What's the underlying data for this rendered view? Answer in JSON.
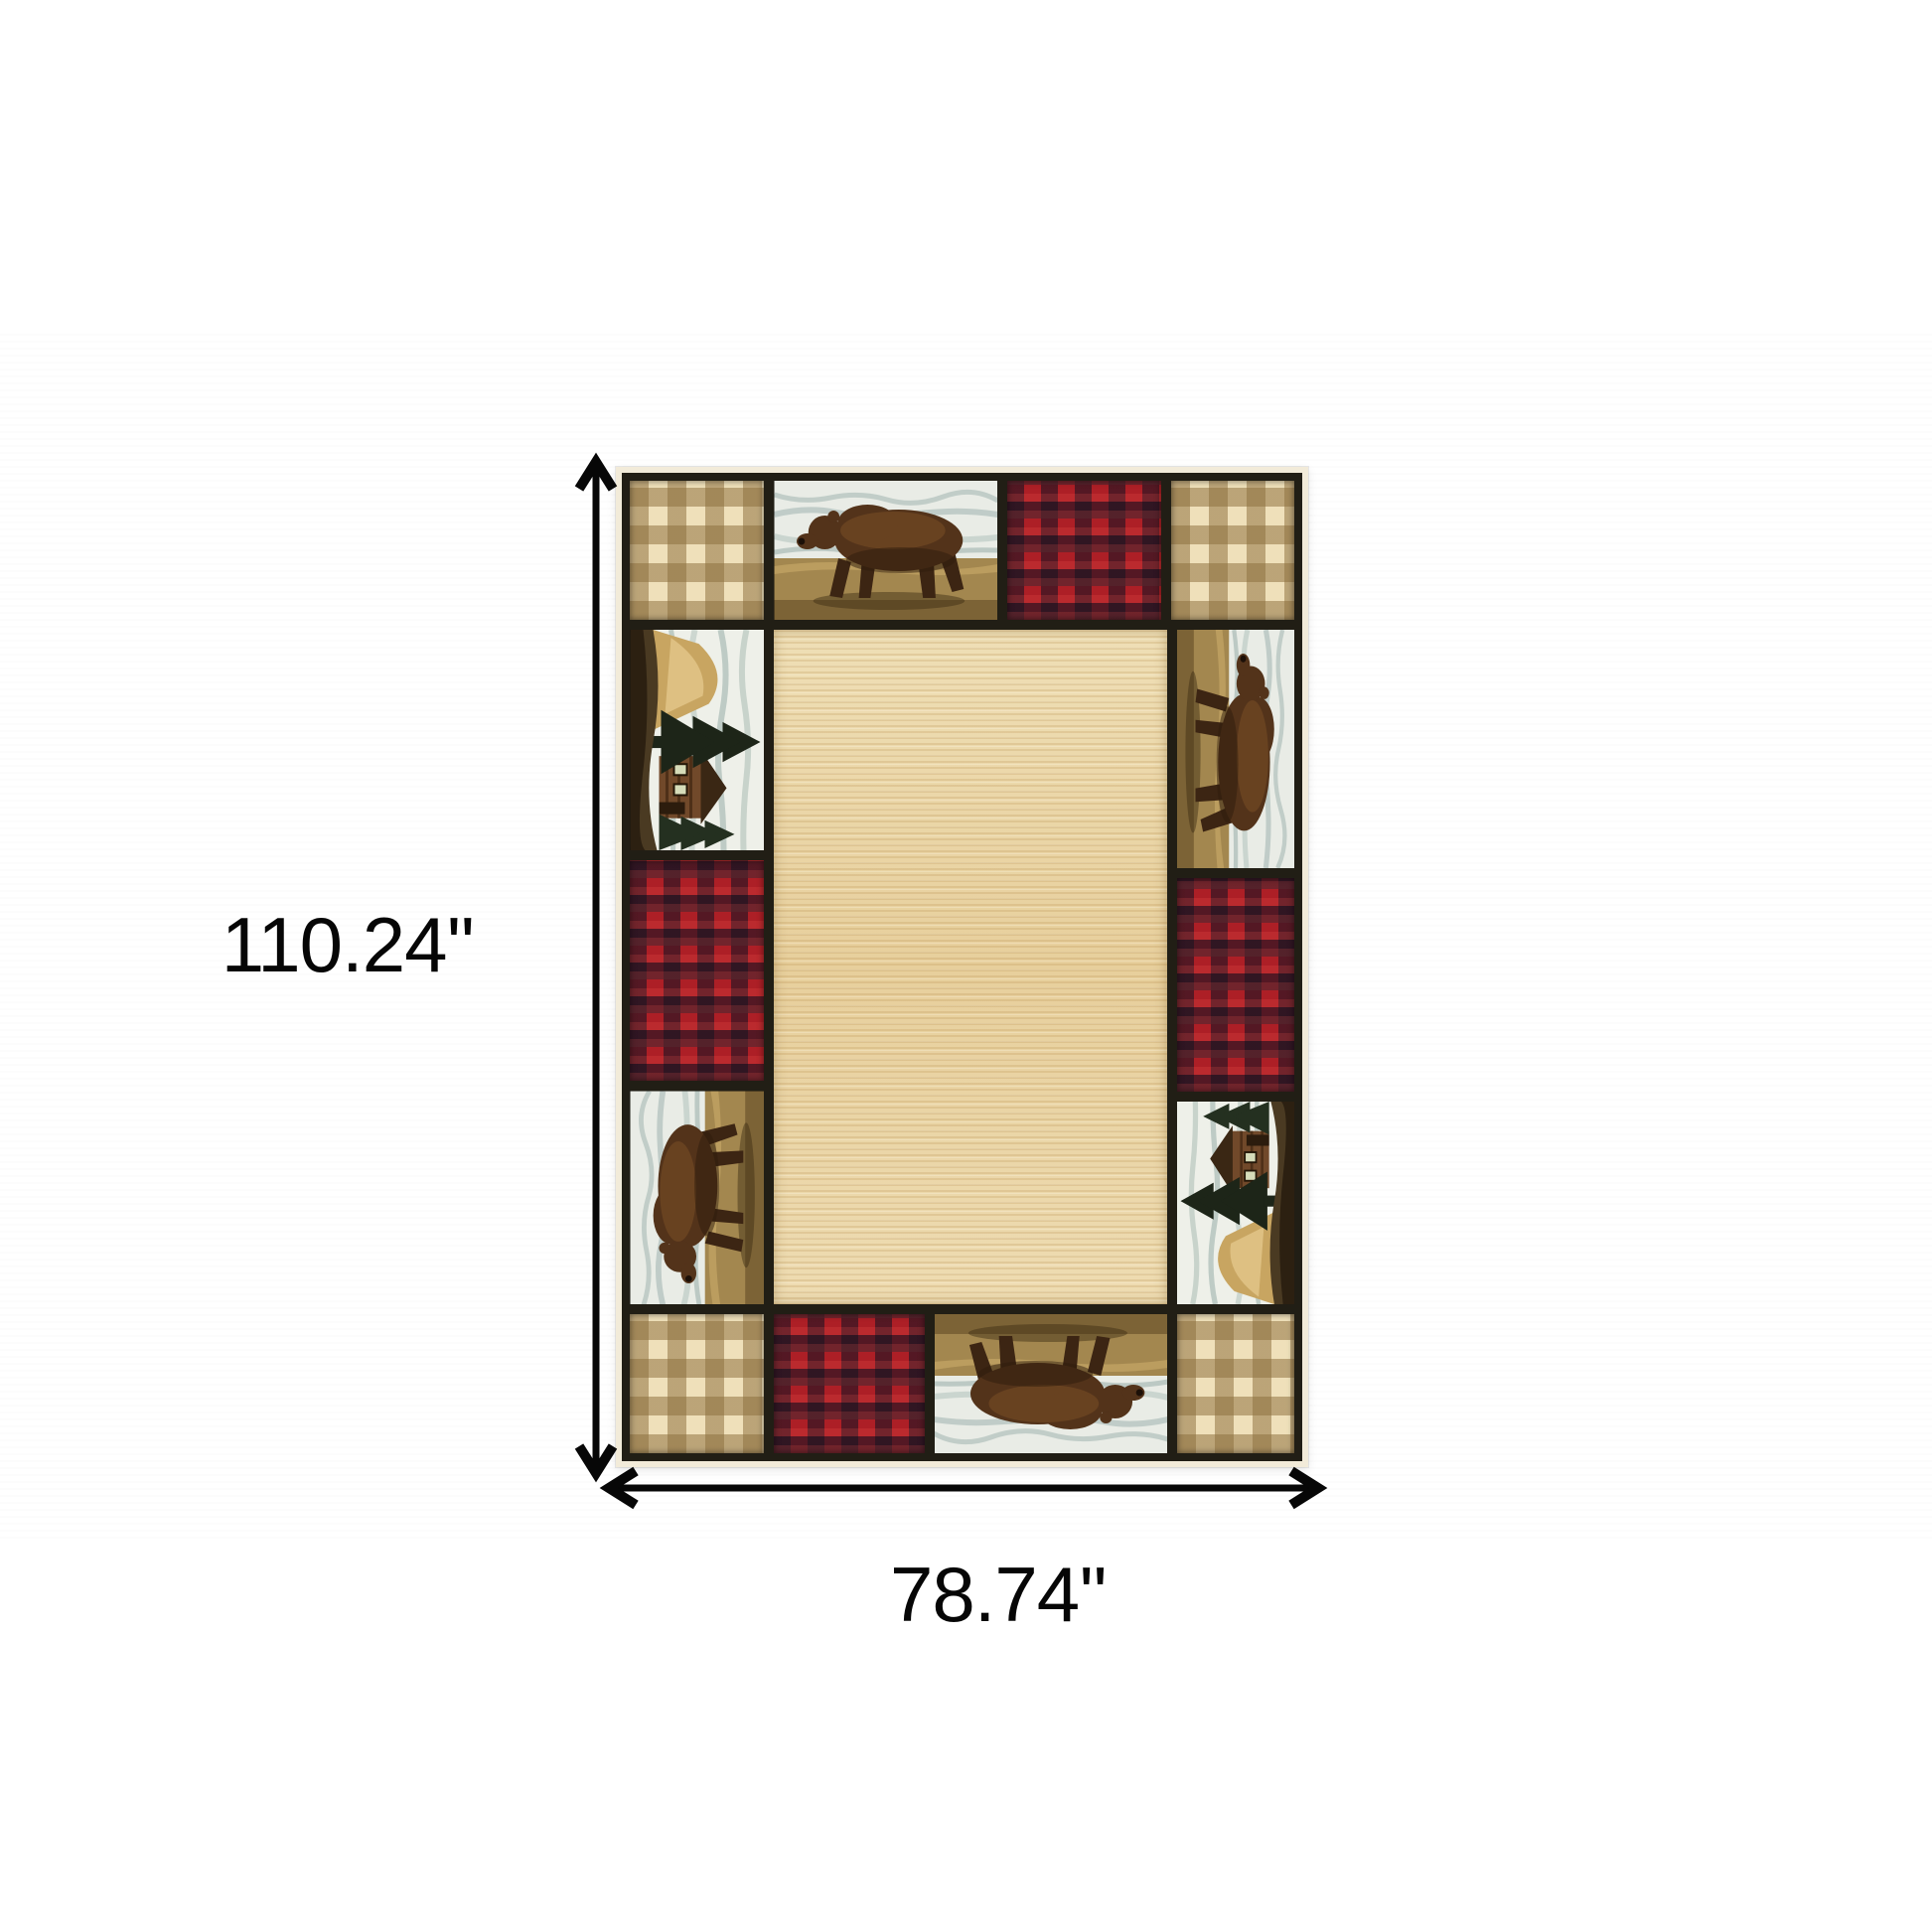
{
  "diagram": {
    "height_label": "110.24''",
    "width_label": "78.74''",
    "annotation_color": "#070707"
  },
  "rug": {
    "description": "rustic lodge-style area rug with patchwork border of bears, cabins, buffalo plaid and gingham checks around a plain beige field",
    "border_motifs": {
      "top_row": [
        "tan-gingham-check",
        "walking-bear-scene",
        "red-buffalo-plaid",
        "tan-gingham-check"
      ],
      "left_column": [
        "cabin-scene",
        "red-buffalo-plaid",
        "walking-bear-scene"
      ],
      "right_column": [
        "walking-bear-scene",
        "red-buffalo-plaid",
        "cabin-scene"
      ],
      "bottom_row": [
        "tan-gingham-check",
        "red-buffalo-plaid",
        "walking-bear-scene",
        "tan-gingham-check"
      ]
    },
    "colors": {
      "field_beige": "#ebd6a5",
      "fringe_cream": "#f2ebd9",
      "grid_black": "#211e15",
      "plaid_red": "#ad1f26",
      "plaid_dark": "#181422",
      "gingham_light": "#efe0ba",
      "gingham_dark": "#8c6e3c",
      "bear_brown": "#53331a",
      "sky_gray": "#e9ece6",
      "ground_tan": "#a3874f",
      "pine_green": "#1d2518"
    }
  }
}
